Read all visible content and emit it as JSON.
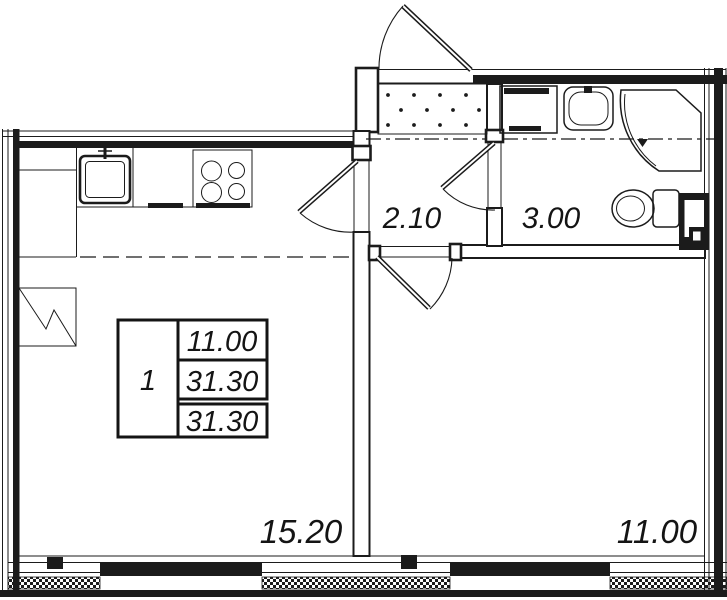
{
  "plan": {
    "type": "apartment-floor-plan",
    "colors": {
      "line": "#1b1b1b",
      "background": "#ffffff"
    },
    "rooms": {
      "hallway": {
        "area": "2.10"
      },
      "bathroom": {
        "area": "3.00"
      },
      "living_kitchen": {
        "area": "15.20"
      },
      "bedroom": {
        "area": "11.00"
      }
    },
    "info_table": {
      "rooms_count": "1",
      "living_area": "11.00",
      "total_area": "31.30",
      "total_area_with_balcony": "31.30"
    },
    "fixtures": [
      "refrigerator",
      "kitchen-sink",
      "kitchen-counter",
      "stove",
      "wardrobe",
      "entrance-door",
      "washing-machine",
      "washbasin",
      "shower-cabin",
      "toilet",
      "duct-shaft"
    ]
  }
}
